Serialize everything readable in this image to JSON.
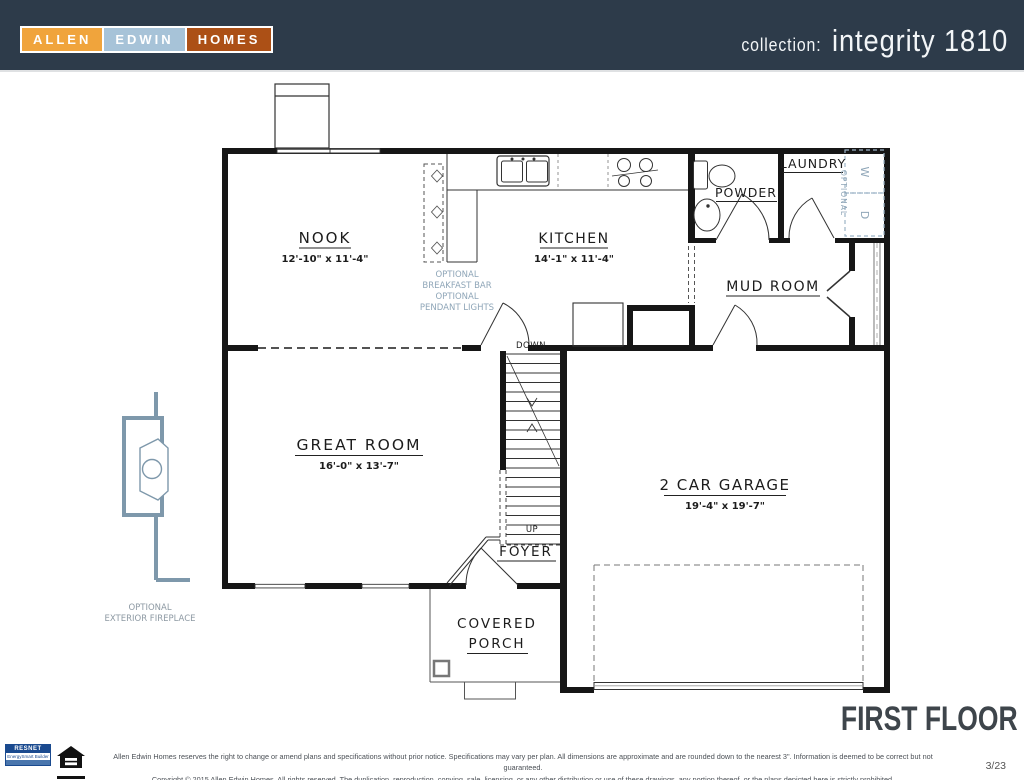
{
  "header": {
    "logo": {
      "allen": "ALLEN",
      "edwin": "EDWIN",
      "homes": "HOMES"
    },
    "collection_label": "collection:",
    "plan_name": "integrity 1810"
  },
  "plan": {
    "rooms": {
      "nook": {
        "name": "NOOK",
        "dims": "12'-10\" x 11'-4\""
      },
      "kitchen": {
        "name": "KITCHEN",
        "dims": "14'-1\" x 11'-4\""
      },
      "powder": {
        "name": "POWDER"
      },
      "laundry": {
        "name": "LAUNDRY"
      },
      "mud_room": {
        "name": "MUD ROOM"
      },
      "great_room": {
        "name": "GREAT ROOM",
        "dims": "16'-0\" x 13'-7\""
      },
      "foyer": {
        "name": "FOYER"
      },
      "garage": {
        "name": "2 CAR GARAGE",
        "dims": "19'-4\" x 19'-7\""
      },
      "covered_porch": {
        "line1": "COVERED",
        "line2": "PORCH"
      }
    },
    "stairs": {
      "down": "DOWN",
      "up": "UP"
    },
    "annotations": {
      "breakfast_bar": [
        "OPTIONAL",
        "BREAKFAST BAR",
        "OPTIONAL",
        "PENDANT LIGHTS"
      ],
      "laundry_optional": "OPTIONAL",
      "washer": "W",
      "dryer": "D",
      "fireplace": [
        "OPTIONAL",
        "EXTERIOR FIREPLACE"
      ]
    }
  },
  "footer": {
    "floor_title": "FIRST FLOOR",
    "sheet_number": "3/23",
    "disclaimer_line1": "Allen Edwin Homes reserves the right to change or amend plans and specifications without prior notice. Specifications may vary per plan. All dimensions are approximate and are rounded down to the nearest 3\". Information is deemed to be correct but not guaranteed.",
    "disclaimer_line2": "Copyright © 2015 Allen Edwin Homes. All rights reserved. The duplication, reproduction, copying, sale, licensing, or any other distribution or use of these drawings, any portion thereof, or the plans depicted here is strictly prohibited.",
    "resnet_label": "RESNET",
    "resnet_sub": "EnergySmart Builder"
  },
  "colors": {
    "header_bg": "#2d3b4a",
    "logo_allen_bg": "#f0a43c",
    "logo_edwin_bg": "#a7c3d8",
    "logo_homes_bg": "#ac5016",
    "optional_blue": "#8fa6b8",
    "fireplace_blue": "#7e98ab",
    "wall_black": "#161616",
    "title_color": "#3e454b",
    "resnet_blue": "#1a4a8f"
  }
}
